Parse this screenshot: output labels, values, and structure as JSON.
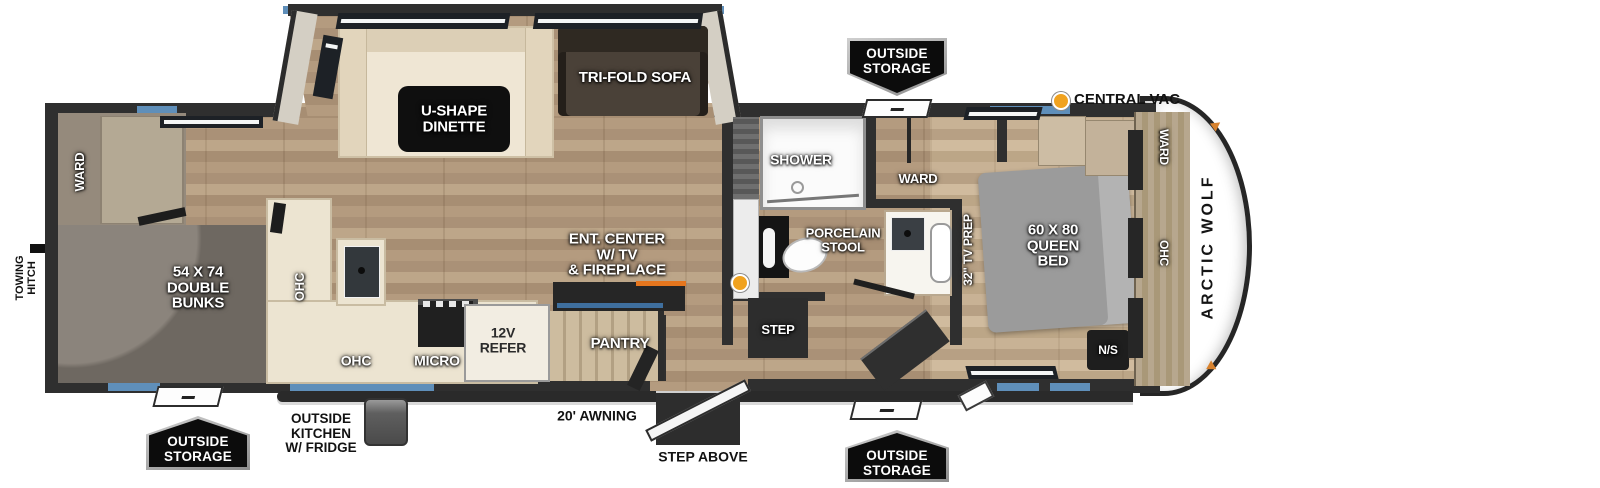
{
  "title": "Arctic Wolf travel trailer floor plan",
  "colors": {
    "accent_blue": "#5f8fba",
    "wall": "#2f2f2f",
    "fireplace_orange": "#e5761e",
    "marker_orange": "#f0a21f"
  },
  "brand": "ARCTIC WOLF",
  "exterior": {
    "outside_storage_top": [
      "OUTSIDE",
      "STORAGE"
    ],
    "outside_storage_bottom_left": [
      "OUTSIDE",
      "STORAGE"
    ],
    "outside_storage_bottom_center": [
      "OUTSIDE",
      "STORAGE"
    ],
    "central_vac": "CENTRAL VAC",
    "towing_hitch": [
      "TOWING",
      "HITCH"
    ],
    "awning": "20' AWNING",
    "step_above": "STEP ABOVE",
    "outside_kitchen": [
      "OUTSIDE",
      "KITCHEN",
      "W/ FRIDGE"
    ]
  },
  "slide_out": {
    "dinette": [
      "U-SHAPE",
      "DINETTE"
    ],
    "sofa": "TRI-FOLD SOFA"
  },
  "bunk_room": {
    "ward": "WARD",
    "bunks": [
      "54 X 74",
      "DOUBLE",
      "BUNKS"
    ]
  },
  "kitchen": {
    "ohc_upper": "OHC",
    "ohc_lower": "OHC",
    "micro": "MICRO",
    "refer": [
      "12V",
      "REFER"
    ],
    "pantry": "PANTRY",
    "ent_center": [
      "ENT. CENTER",
      "W/ TV",
      "& FIREPLACE"
    ]
  },
  "bathroom": {
    "shower": "SHOWER",
    "ward": "WARD",
    "stool": [
      "PORCELAIN",
      "STOOL"
    ],
    "step": "STEP"
  },
  "bedroom": {
    "tv_prep": "32\" TV PREP",
    "bed": [
      "60 X 80",
      "QUEEN",
      "BED"
    ],
    "ward": "WARD",
    "ohc": "OHC",
    "night_stand": "N/S"
  }
}
